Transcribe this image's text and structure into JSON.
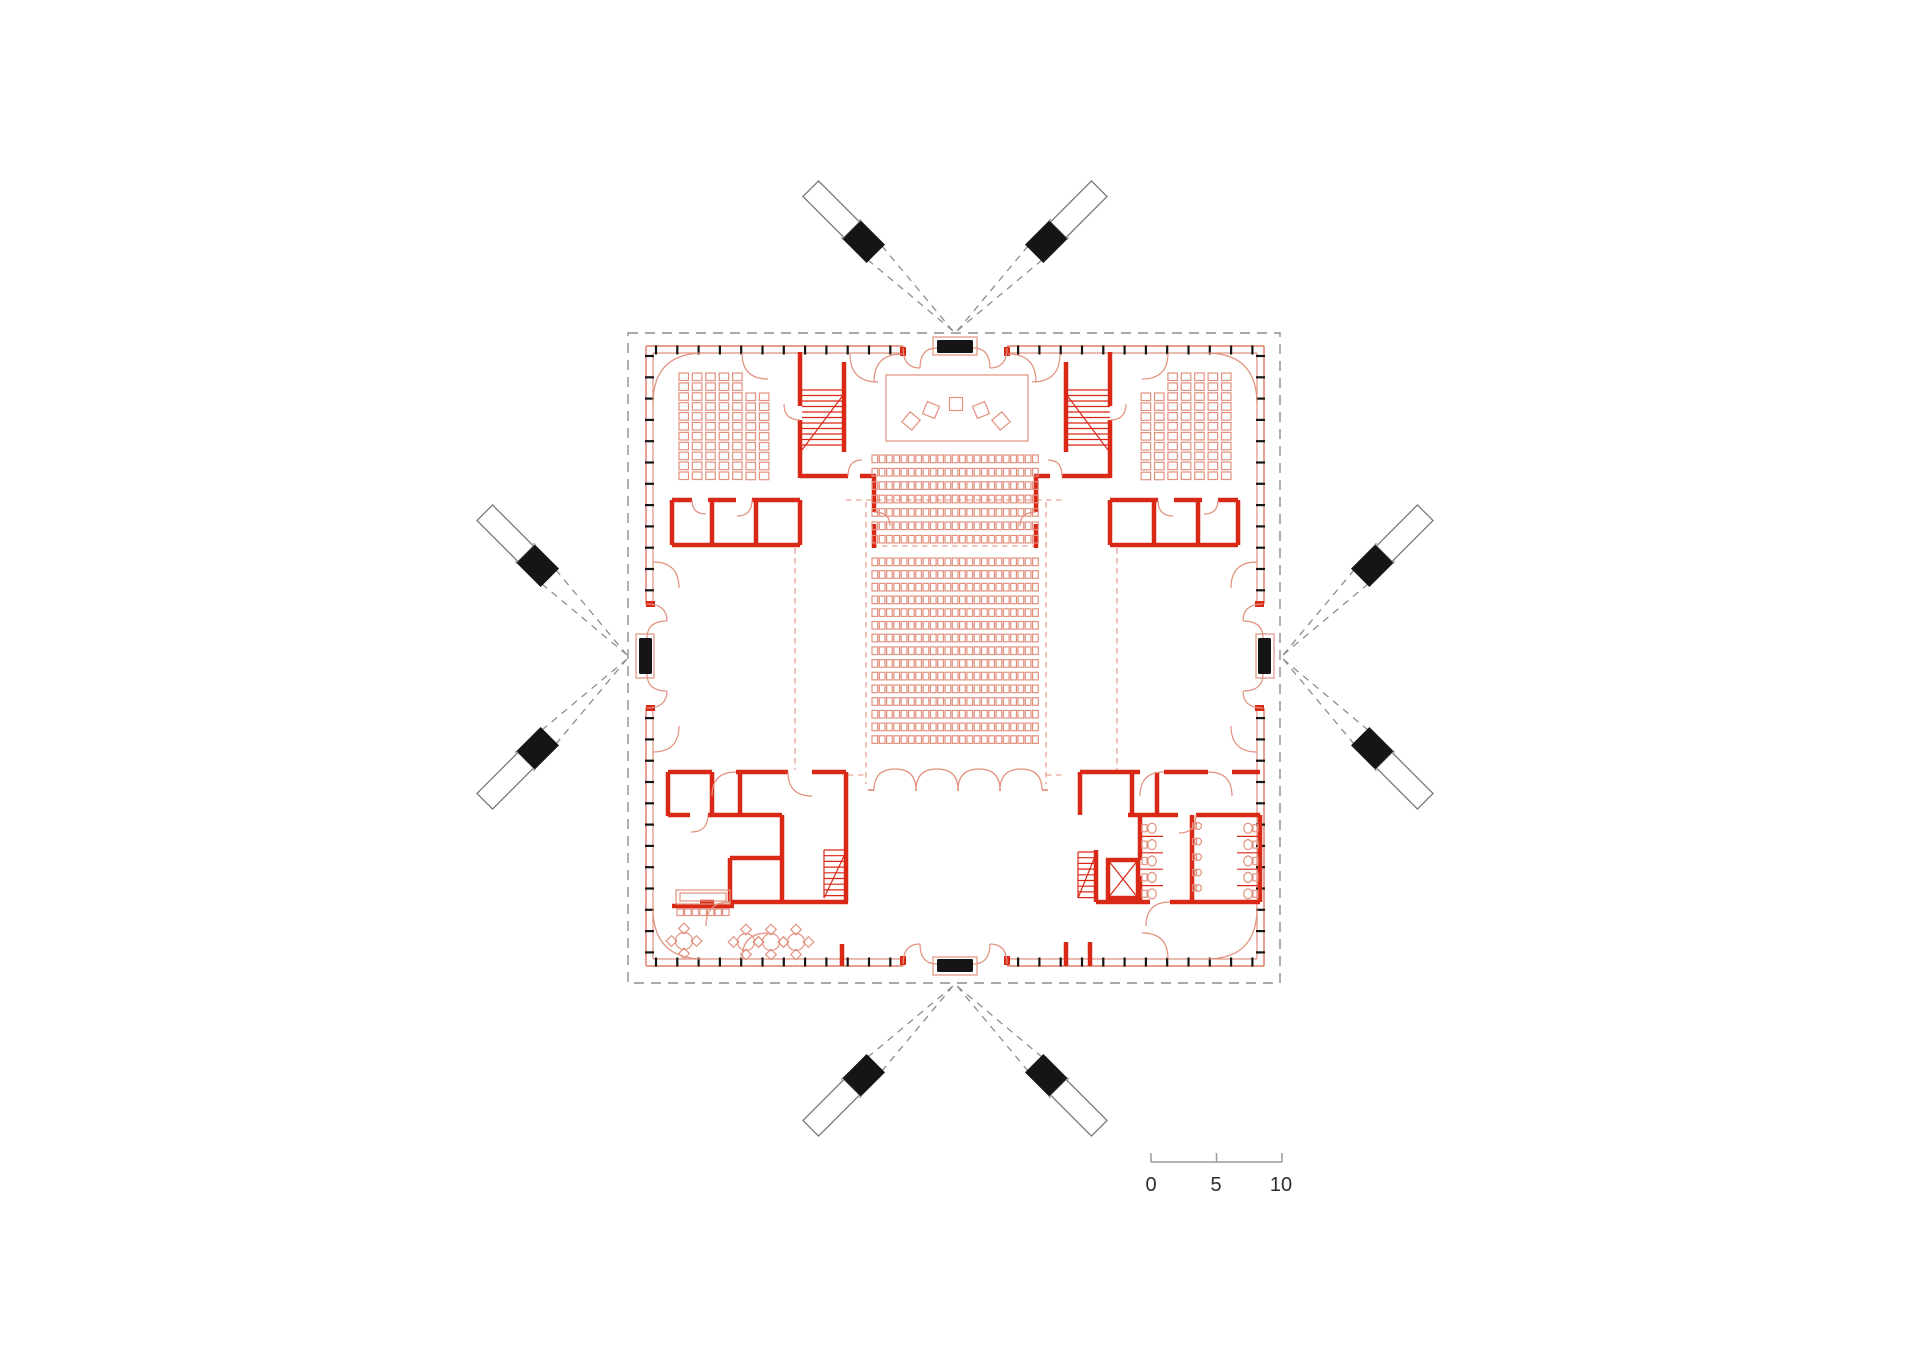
{
  "document": {
    "type": "architectural-floor-plan",
    "page_bg": "#ffffff"
  },
  "colors": {
    "wall_bold": "#da2817",
    "line_thin": "#e2917f",
    "ink": "#151515",
    "roof_dash": "#8e8e8e",
    "mast_stroke": "#7a7a7a",
    "scale_line": "#9a9a9a",
    "scale_text": "#2d2d2d"
  },
  "scale_bar": {
    "labels": [
      "0",
      "5",
      "10"
    ]
  },
  "plan": {
    "facade_ticks": {
      "spacing": 21.3,
      "len": 9,
      "entrance_halfgap": 57,
      "sides": [
        {
          "o": "h",
          "y": 350,
          "t0": 656,
          "t1": 1254,
          "c": 955
        },
        {
          "o": "h",
          "y": 962,
          "t0": 656,
          "t1": 1254,
          "c": 955
        },
        {
          "o": "v",
          "x": 649.5,
          "t0": 356,
          "t1": 956,
          "c": 656
        },
        {
          "o": "v",
          "x": 1260.5,
          "t0": 356,
          "t1": 956,
          "c": 656
        }
      ]
    },
    "masts": {
      "width": 26,
      "black_from": 112,
      "black_to": 146,
      "white_to": 204,
      "guy_len": 148,
      "guy_half": 13,
      "items": [
        {
          "anchor": [
            955,
            333
          ],
          "angles": [
            -135,
            -45
          ]
        },
        {
          "anchor": [
            629,
            657
          ],
          "angles": [
            -135,
            135
          ]
        },
        {
          "anchor": [
            1281,
            657
          ],
          "angles": [
            -45,
            45
          ]
        },
        {
          "anchor": [
            955,
            984
          ],
          "angles": [
            45,
            135
          ]
        }
      ]
    },
    "auditorium": {
      "x": 872,
      "cols": 23,
      "col_pitch": 7.3,
      "seat_w": 5.7,
      "seat_h": 7.6,
      "blocks": [
        {
          "y": 455,
          "rows": 7,
          "row_pitch": 13.4
        },
        {
          "y": 558,
          "rows": 15,
          "row_pitch": 12.7
        }
      ]
    },
    "stage": {
      "size": 13,
      "chairs": [
        {
          "x": 911,
          "y": 421,
          "r": 40
        },
        {
          "x": 931,
          "y": 410,
          "r": 22
        },
        {
          "x": 956,
          "y": 404,
          "r": 0
        },
        {
          "x": 981,
          "y": 410,
          "r": -22
        },
        {
          "x": 1001,
          "y": 421,
          "r": -40
        }
      ]
    },
    "side_seating": {
      "origin": [
        679,
        373
      ],
      "col_pitch": 13.4,
      "row_pitch": 9.9,
      "seat_w": 9.5,
      "seat_h": 7.5,
      "cols": [
        {
          "dx": 0,
          "dy": 0,
          "n": 11
        },
        {
          "dx": 1,
          "dy": 0,
          "n": 11
        },
        {
          "dx": 2,
          "dy": 0,
          "n": 11
        },
        {
          "dx": 3,
          "dy": 0,
          "n": 11
        },
        {
          "dx": 4,
          "dy": 0,
          "n": 11
        },
        {
          "dx": 5,
          "dy": 20,
          "n": 9
        },
        {
          "dx": 6,
          "dy": 20,
          "n": 9
        }
      ]
    },
    "cafe": {
      "table_r": 8.5,
      "chair_size": 7.5,
      "chair_off": 12.5,
      "tables": [
        {
          "x": 684,
          "y": 941
        },
        {
          "x": 746,
          "y": 942
        },
        {
          "x": 771,
          "y": 942
        },
        {
          "x": 796,
          "y": 942
        }
      ],
      "stools": {
        "x0": 677,
        "y": 909,
        "n": 7,
        "pitch": 7.6,
        "size": 6.5
      }
    },
    "wc": {
      "y0": 820,
      "pitch": 16.4,
      "stalls": 5,
      "banks": [
        {
          "wall_x": 1140,
          "dir": 1,
          "len": 23
        },
        {
          "wall_x": 1260,
          "dir": -1,
          "len": 23
        }
      ],
      "basins": {
        "x": 1198,
        "y0": 826,
        "pitch": 15.5,
        "n": 5,
        "r": 3.4
      }
    },
    "stairs": [
      {
        "x": 802,
        "w": 42,
        "y0": 390,
        "n": 11,
        "step": 5.5
      },
      {
        "x": 1066,
        "w": 44,
        "y0": 390,
        "n": 11,
        "step": 5.5
      },
      {
        "x": 824,
        "w": 22,
        "y0": 850,
        "n": 9,
        "step": 5.7
      },
      {
        "x": 1078,
        "w": 18,
        "y0": 852,
        "n": 9,
        "step": 5.7
      }
    ],
    "door_row": {
      "x0": 874,
      "doorways": 4,
      "w": 42,
      "y": 790,
      "leaf": 21
    }
  }
}
